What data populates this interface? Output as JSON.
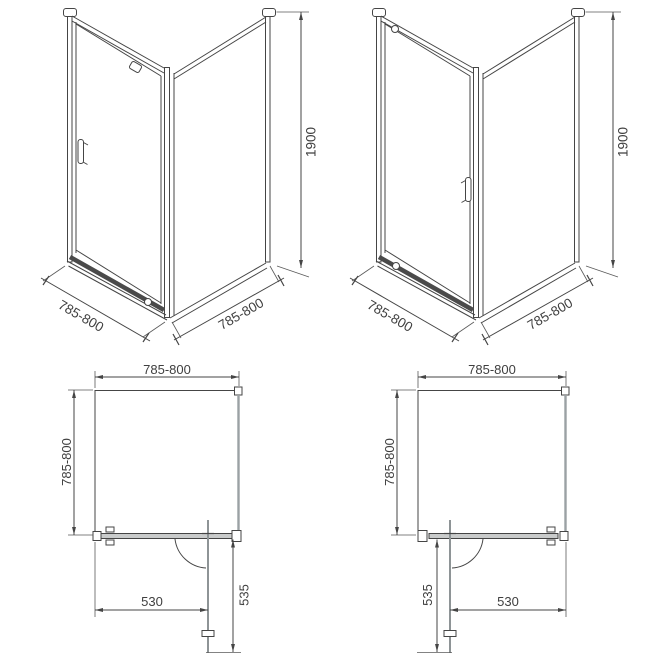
{
  "diagram": {
    "kind": "shower-enclosure-technical-drawing",
    "colors": {
      "line": "#454545",
      "glass": "#9ba1a4",
      "band_fill": "#c9cbcb",
      "background": "#ffffff"
    },
    "views": {
      "iso_left": {
        "door_width_label": "785-800",
        "panel_width_label": "785-800",
        "height_label": "1900"
      },
      "iso_right": {
        "door_width_label": "785-800",
        "panel_width_label": "785-800",
        "height_label": "1900"
      },
      "plan_left": {
        "width_label": "785-800",
        "depth_label": "785-800",
        "entry_width_label": "530",
        "door_extension_label": "535"
      },
      "plan_right": {
        "width_label": "785-800",
        "depth_label": "785-800",
        "entry_width_label": "530",
        "door_extension_label": "535"
      }
    }
  }
}
